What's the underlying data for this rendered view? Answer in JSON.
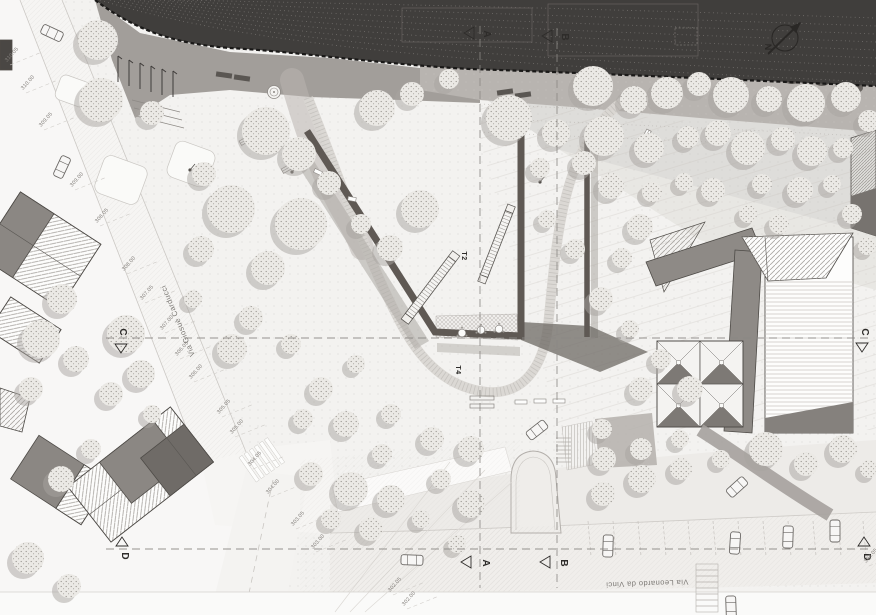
{
  "document": {
    "type": "architectural site plan / masterplan",
    "width_px": 876,
    "height_px": 615
  },
  "labels": {
    "street_left": "Via Giosuè Carducci",
    "street_bottom": "Via Leonardo da Vinci",
    "ramp_upper": "T2",
    "ramp_lower": "T4",
    "north_letter": "N"
  },
  "palette": {
    "hillside_dark": "#403e3c",
    "contour_dotted": "#8a8683",
    "gravel_band": "#b8b4b0",
    "platform_grey": "#a29e9a",
    "park_ground": "#f3f2f0",
    "tree_fill": "#ebe9e5",
    "tree_shadow": "#a8a4a0",
    "building_grey": "#8e8a86",
    "building_dark": "#6f6b67",
    "wall_dark": "#5f5954",
    "road_light": "#f6f5f3",
    "annotation_grey": "#8b8784",
    "text_dark": "#2e2c2a"
  },
  "section_lines": {
    "vertical": [
      {
        "id": "A",
        "x": 480,
        "y1": 26,
        "y2": 588
      },
      {
        "id": "B",
        "x": 557,
        "y1": 28,
        "y2": 588
      }
    ],
    "horizontal": [
      {
        "id": "C",
        "y": 338,
        "x1": 106,
        "x2": 868
      },
      {
        "id": "D",
        "y": 549,
        "x1": 106,
        "x2": 868
      }
    ]
  },
  "section_markers": [
    {
      "letter": "A",
      "lx": 484,
      "ly": 34,
      "tri": "left",
      "tx": 470,
      "ty": 33
    },
    {
      "letter": "B",
      "lx": 562,
      "ly": 37,
      "tri": "left",
      "tx": 548,
      "ty": 36
    },
    {
      "letter": "A",
      "lx": 483,
      "ly": 563,
      "tri": "left",
      "tx": 467,
      "ty": 562
    },
    {
      "letter": "B",
      "lx": 561,
      "ly": 563,
      "tri": "left",
      "tx": 546,
      "ty": 562
    },
    {
      "letter": "C",
      "lx": 120,
      "ly": 332,
      "tri": "down",
      "tx": 121,
      "ty": 347
    },
    {
      "letter": "C",
      "lx": 862,
      "ly": 332,
      "tri": "down",
      "tx": 862,
      "ty": 346
    },
    {
      "letter": "D",
      "lx": 122,
      "ly": 556,
      "tri": "up",
      "tx": 122,
      "ty": 543
    },
    {
      "letter": "D",
      "lx": 864,
      "ly": 557,
      "tri": "up",
      "tx": 864,
      "ty": 543
    }
  ],
  "spot_elevations": [
    [
      "310.05",
      7,
      62
    ],
    [
      "310.00",
      23,
      90
    ],
    [
      "309.05",
      41,
      127
    ],
    [
      "309.00",
      72,
      187
    ],
    [
      "308.05",
      97,
      223
    ],
    [
      "308.00",
      124,
      271
    ],
    [
      "307.05",
      142,
      300
    ],
    [
      "307.00",
      162,
      330
    ],
    [
      "306.05",
      177,
      356
    ],
    [
      "306.00",
      191,
      379
    ],
    [
      "305.05",
      219,
      414
    ],
    [
      "305.00",
      232,
      434
    ],
    [
      "304.05",
      250,
      466
    ],
    [
      "304.00",
      268,
      494
    ],
    [
      "303.05",
      293,
      526
    ],
    [
      "303.00",
      313,
      549
    ],
    [
      "302.05",
      390,
      592
    ],
    [
      "302.00",
      404,
      606
    ],
    [
      "304.05",
      866,
      563
    ]
  ],
  "trees": [
    [
      593,
      86,
      20
    ],
    [
      634,
      100,
      14
    ],
    [
      667,
      93,
      16
    ],
    [
      699,
      84,
      12
    ],
    [
      731,
      95,
      18
    ],
    [
      769,
      99,
      13
    ],
    [
      806,
      103,
      19
    ],
    [
      846,
      97,
      15
    ],
    [
      869,
      121,
      11
    ],
    [
      604,
      136,
      20
    ],
    [
      649,
      148,
      15
    ],
    [
      688,
      137,
      11
    ],
    [
      718,
      133,
      13
    ],
    [
      748,
      148,
      17
    ],
    [
      783,
      139,
      12
    ],
    [
      812,
      151,
      15
    ],
    [
      843,
      148,
      10
    ],
    [
      611,
      186,
      13
    ],
    [
      652,
      192,
      10
    ],
    [
      684,
      182,
      9
    ],
    [
      713,
      190,
      12
    ],
    [
      762,
      184,
      10
    ],
    [
      800,
      190,
      13
    ],
    [
      832,
      184,
      9
    ],
    [
      748,
      214,
      9
    ],
    [
      779,
      224,
      10
    ],
    [
      852,
      214,
      10
    ],
    [
      867,
      246,
      9
    ],
    [
      640,
      227,
      13
    ],
    [
      622,
      258,
      10
    ],
    [
      266,
      131,
      24
    ],
    [
      299,
      154,
      17
    ],
    [
      329,
      183,
      12
    ],
    [
      377,
      108,
      18
    ],
    [
      412,
      94,
      12
    ],
    [
      449,
      79,
      10
    ],
    [
      509,
      118,
      23
    ],
    [
      556,
      133,
      14
    ],
    [
      584,
      163,
      12
    ],
    [
      540,
      168,
      10
    ],
    [
      420,
      209,
      19
    ],
    [
      390,
      248,
      13
    ],
    [
      361,
      224,
      10
    ],
    [
      301,
      224,
      26
    ],
    [
      268,
      268,
      17
    ],
    [
      231,
      209,
      24
    ],
    [
      201,
      249,
      13
    ],
    [
      251,
      318,
      12
    ],
    [
      291,
      344,
      10
    ],
    [
      232,
      349,
      15
    ],
    [
      193,
      299,
      9
    ],
    [
      321,
      389,
      12
    ],
    [
      356,
      364,
      9
    ],
    [
      303,
      419,
      10
    ],
    [
      346,
      424,
      13
    ],
    [
      391,
      414,
      10
    ],
    [
      432,
      439,
      12
    ],
    [
      471,
      449,
      13
    ],
    [
      382,
      454,
      10
    ],
    [
      601,
      299,
      12
    ],
    [
      630,
      329,
      9
    ],
    [
      661,
      359,
      10
    ],
    [
      641,
      389,
      12
    ],
    [
      690,
      389,
      13
    ],
    [
      602,
      429,
      10
    ],
    [
      641,
      449,
      11
    ],
    [
      680,
      439,
      9
    ],
    [
      604,
      459,
      12
    ],
    [
      575,
      249,
      10
    ],
    [
      547,
      219,
      9
    ],
    [
      98,
      40,
      20
    ],
    [
      101,
      100,
      22
    ],
    [
      152,
      113,
      12
    ],
    [
      204,
      174,
      12
    ],
    [
      126,
      334,
      19
    ],
    [
      141,
      374,
      14
    ],
    [
      111,
      394,
      12
    ],
    [
      152,
      414,
      9
    ],
    [
      62,
      299,
      15
    ],
    [
      41,
      339,
      19
    ],
    [
      76,
      359,
      13
    ],
    [
      31,
      389,
      12
    ],
    [
      91,
      449,
      10
    ],
    [
      61,
      479,
      13
    ],
    [
      28,
      558,
      16
    ],
    [
      69,
      586,
      12
    ],
    [
      311,
      474,
      12
    ],
    [
      351,
      489,
      17
    ],
    [
      391,
      499,
      14
    ],
    [
      331,
      519,
      10
    ],
    [
      371,
      529,
      12
    ],
    [
      471,
      504,
      14
    ],
    [
      441,
      479,
      10
    ],
    [
      421,
      519,
      9
    ],
    [
      457,
      544,
      9
    ],
    [
      603,
      494,
      12
    ],
    [
      642,
      479,
      14
    ],
    [
      681,
      469,
      11
    ],
    [
      721,
      459,
      9
    ],
    [
      766,
      449,
      17
    ],
    [
      806,
      464,
      12
    ],
    [
      843,
      449,
      14
    ],
    [
      869,
      469,
      9
    ]
  ],
  "cars": [
    [
      52,
      33,
      25
    ],
    [
      62,
      167,
      115
    ],
    [
      412,
      560,
      2
    ],
    [
      537,
      430,
      -38
    ],
    [
      737,
      487,
      -42
    ],
    [
      608,
      546,
      92
    ],
    [
      735,
      543,
      94
    ],
    [
      788,
      537,
      92
    ],
    [
      835,
      531,
      90
    ],
    [
      731,
      607,
      88
    ]
  ],
  "ramps": [
    {
      "x1": 409,
      "y1": 316,
      "x2": 452,
      "y2": 259,
      "w": 9
    },
    {
      "x1": 484,
      "y1": 276,
      "x2": 509,
      "y2": 212,
      "w": 8
    }
  ],
  "furniture": {
    "flag_poles": [
      [
        118,
        56
      ],
      [
        129,
        60
      ],
      [
        140,
        63
      ],
      [
        151,
        66
      ],
      [
        162,
        69
      ],
      [
        173,
        71
      ]
    ],
    "benches_dark": [
      [
        224,
        75,
        8
      ],
      [
        242,
        78,
        8
      ],
      [
        505,
        92,
        -8
      ],
      [
        523,
        95,
        -8
      ]
    ],
    "benches_light": [
      [
        246,
        140,
        -30
      ],
      [
        646,
        136,
        -62
      ],
      [
        288,
        168,
        -30
      ]
    ],
    "lamps": [
      [
        190,
        170
      ],
      [
        292,
        172
      ],
      [
        540,
        182
      ]
    ],
    "play_items": [
      [
        318,
        172,
        25
      ],
      [
        334,
        188,
        50
      ],
      [
        352,
        199,
        10
      ]
    ],
    "terrace_tables": [
      [
        462,
        333
      ],
      [
        481,
        330
      ],
      [
        499,
        329
      ]
    ],
    "planters": [
      [
        521,
        402
      ],
      [
        540,
        401
      ],
      [
        559,
        401
      ]
    ],
    "picnic_table": [
      482,
      402
    ],
    "fountain": [
      274,
      92
    ]
  },
  "pyramid_roof": {
    "x": 657,
    "y": 341,
    "cell": 43,
    "rows": 2,
    "cols": 2
  }
}
